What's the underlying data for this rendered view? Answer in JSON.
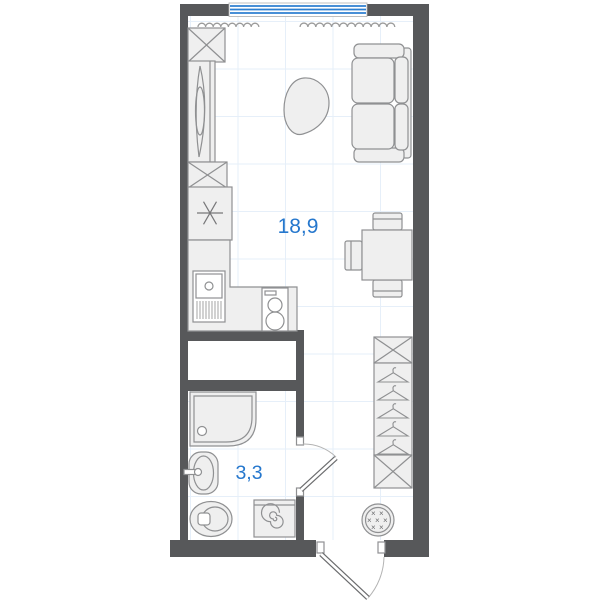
{
  "plan": {
    "title": "studio apartment floor plan",
    "rooms": [
      {
        "id": "living-kitchen",
        "area_label": "18,9"
      },
      {
        "id": "bathroom",
        "area_label": "3,3"
      }
    ],
    "colors": {
      "wall": "#57585a",
      "line": "#8f9092",
      "line-dark": "#6b6c6e",
      "fill": "#efefef",
      "grid": "#e6eff9",
      "label": "#2577cd",
      "window": "#2e7fd0"
    },
    "furniture": {
      "living_kitchen": [
        "cabinet",
        "wardrobe-with-mirror",
        "cabinet",
        "refrigerator",
        "kitchen-counter",
        "sink",
        "stove",
        "pouf",
        "sofa",
        "dining-table",
        "chair",
        "chair",
        "chair"
      ],
      "hallway": [
        "closet-top-shelf",
        "hanger-rail",
        "closet-bottom-shelf",
        "round-pouf"
      ],
      "bathroom": [
        "shower",
        "washbasin",
        "toilet",
        "washing-machine"
      ],
      "openings": [
        "window",
        "entrance-door",
        "bathroom-door",
        "radiator",
        "radiator"
      ]
    }
  }
}
